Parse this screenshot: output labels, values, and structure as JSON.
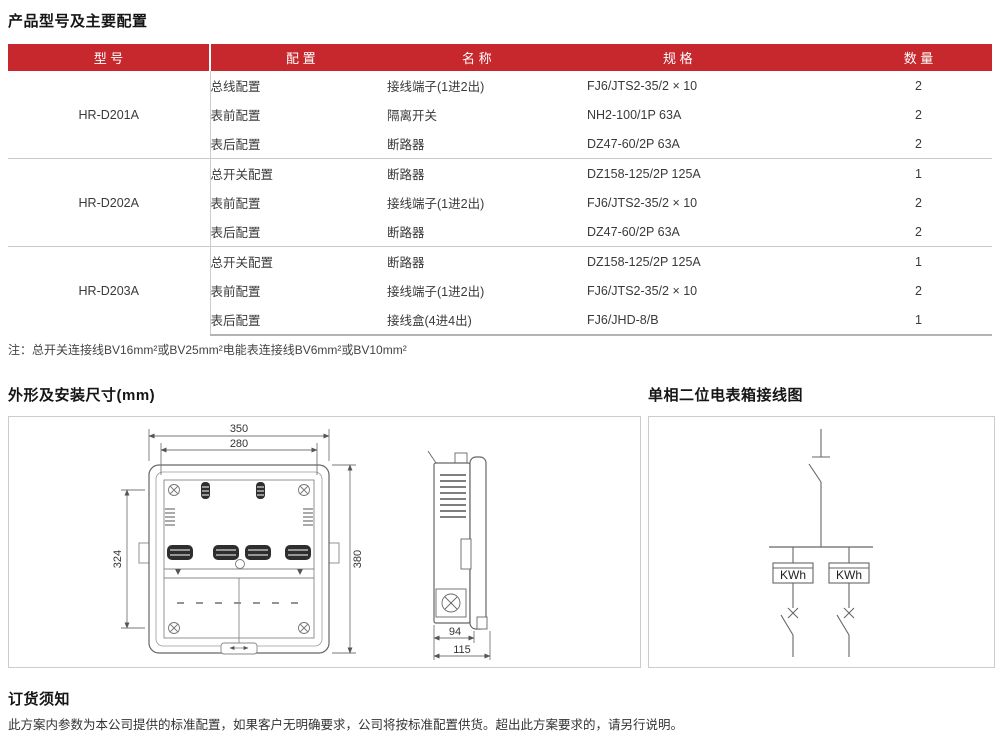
{
  "colors": {
    "header_red": "#C6282D",
    "line_gray": "#c9c9c9"
  },
  "sections": {
    "products": {
      "title": "产品型号及主要配置"
    },
    "dimensions": {
      "title": "外形及安装尺寸(mm)"
    },
    "wiring": {
      "title": "单相二位电表箱接线图"
    },
    "ordering": {
      "title": "订货须知",
      "text": "此方案内参数为本公司提供的标准配置，如果客户无明确要求，公司将按标准配置供货。超出此方案要求的，请另行说明。"
    }
  },
  "table": {
    "headers": {
      "model": "型 号",
      "config": "配 置",
      "name": "名 称",
      "spec": "规 格",
      "qty": "数 量"
    },
    "note": "注：总开关连接线BV16mm²或BV25mm²电能表连接线BV6mm²或BV10mm²",
    "groups": [
      {
        "model": "HR-D201A",
        "rows": [
          {
            "config": "总线配置",
            "name": "接线端子(1进2出)",
            "spec": "FJ6/JTS2-35/2 × 10",
            "qty": "2"
          },
          {
            "config": "表前配置",
            "name": "隔离开关",
            "spec": "NH2-100/1P 63A",
            "qty": "2"
          },
          {
            "config": "表后配置",
            "name": "断路器",
            "spec": "DZ47-60/2P 63A",
            "qty": "2"
          }
        ]
      },
      {
        "model": "HR-D202A",
        "rows": [
          {
            "config": "总开关配置",
            "name": "断路器",
            "spec": "DZ158-125/2P 125A",
            "qty": "1"
          },
          {
            "config": "表前配置",
            "name": "接线端子(1进2出)",
            "spec": "FJ6/JTS2-35/2 × 10",
            "qty": "2"
          },
          {
            "config": "表后配置",
            "name": "断路器",
            "spec": "DZ47-60/2P 63A",
            "qty": "2"
          }
        ]
      },
      {
        "model": "HR-D203A",
        "rows": [
          {
            "config": "总开关配置",
            "name": "断路器",
            "spec": "DZ158-125/2P 125A",
            "qty": "1"
          },
          {
            "config": "表前配置",
            "name": "接线端子(1进2出)",
            "spec": "FJ6/JTS2-35/2 × 10",
            "qty": "2"
          },
          {
            "config": "表后配置",
            "name": "接线盒(4进4出)",
            "spec": "FJ6/JHD-8/B",
            "qty": "1"
          }
        ]
      }
    ]
  },
  "drawing": {
    "front": {
      "dim_width_outer": "350",
      "dim_width_inner": "280",
      "dim_height_mount": "324",
      "dim_height_outer": "380"
    },
    "side": {
      "dim_depth_body": "94",
      "dim_depth_total": "115"
    }
  },
  "wiring_diagram": {
    "meter1_label": "KWh",
    "meter2_label": "KWh"
  }
}
